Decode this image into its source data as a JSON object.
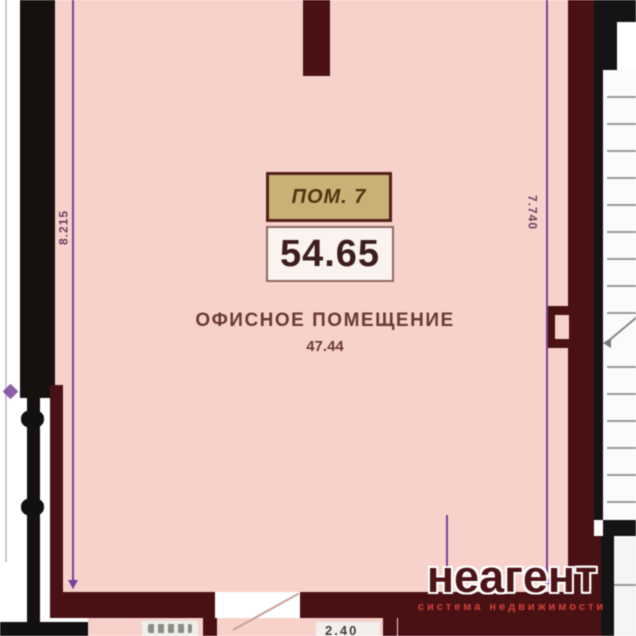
{
  "room": {
    "tag_label": "ПОМ. 7",
    "tag_area": "54.65",
    "name": "ОФИСНОЕ ПОМЕЩЕНИЕ",
    "area": "47.44"
  },
  "dimensions": {
    "left_vertical": "8.215",
    "right_vertical": "7.740",
    "bottom_right_partial": "2.40"
  },
  "watermark": {
    "brand": "неагент",
    "tagline": "система недвижимости"
  },
  "colors": {
    "room_fill": "#f7d2cb",
    "wall_maroon": "#4a1114",
    "wall_black": "#141414",
    "dimension_purple": "#7b3f98",
    "tag_fill": "#c7b176",
    "brand_red": "#cd4237"
  }
}
